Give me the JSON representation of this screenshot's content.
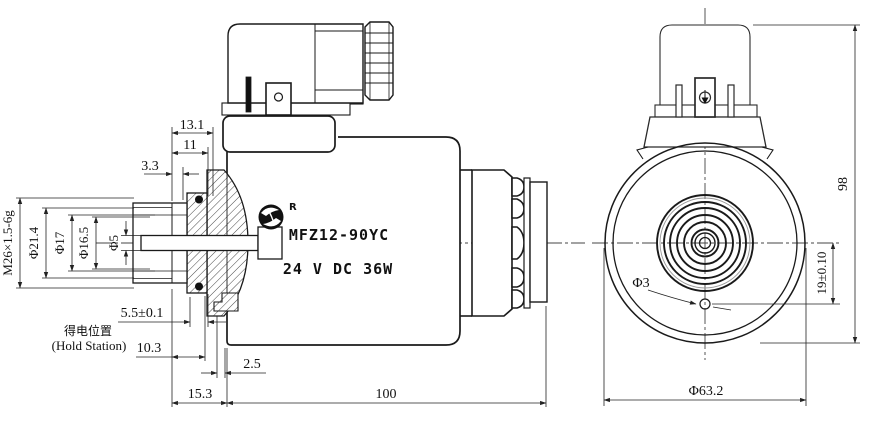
{
  "title": "MFZ12-90YC wet-pin DC solenoid engineering drawing",
  "label": {
    "model": "MFZ12-90YC",
    "rating": "24 V DC 36W",
    "registered": "R"
  },
  "side": {
    "d13_1": "13.1",
    "d11": "11",
    "d3_3": "3.3",
    "thread": "M26×1.5-6g",
    "dia21_4": "Φ21.4",
    "dia17": "Φ17",
    "dia16_5": "Φ16.5",
    "dia5": "Φ5",
    "d5_5": "5.5±0.1",
    "hold_cn": "得电位置",
    "hold_en": "(Hold Station)",
    "d10_3": "10.3",
    "d2_5": "2.5",
    "d15_3": "15.3",
    "d100": "100"
  },
  "front": {
    "d98": "98",
    "dia3": "Φ3",
    "d19": "19±0.10",
    "dia63_2": "Φ63.2"
  },
  "colors": {
    "line": "#1a1a1a",
    "dim": "#222222",
    "paper": "#ffffff"
  }
}
